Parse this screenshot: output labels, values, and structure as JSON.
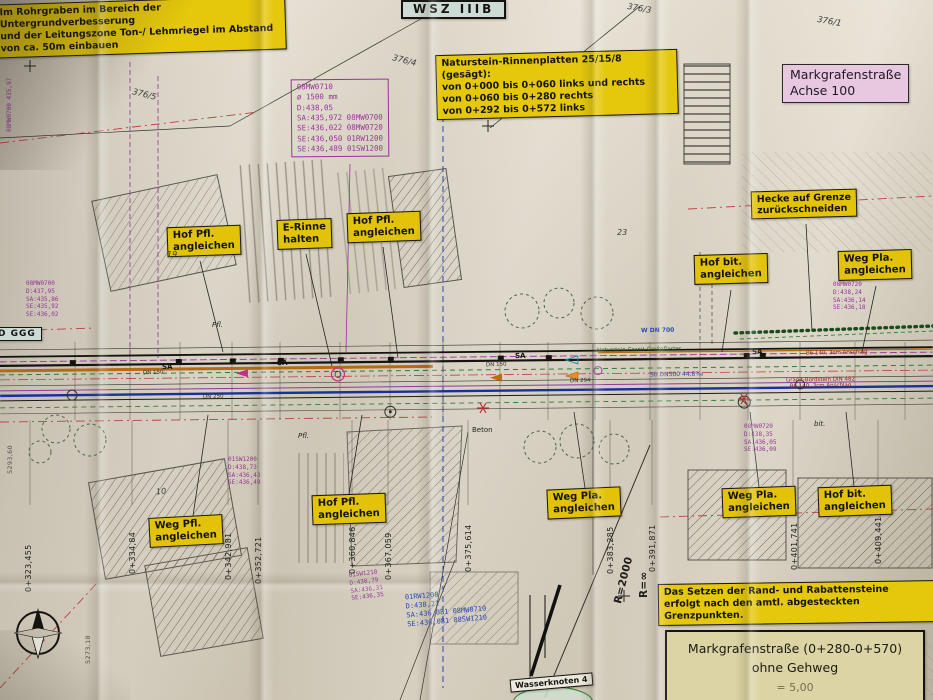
{
  "plan": {
    "zone_box": "WSZ IIIB",
    "axis_box": "Markgrafenstraße\nAchse 100",
    "left_edge_tag": "D GGG",
    "wasserknoten_tag": "Wasserknoten 4",
    "title_block": {
      "line1": "Markgrafenstraße (0+280-0+570)",
      "line2": "ohne Gehweg",
      "line3_partial": "= 5,00"
    }
  },
  "notes": {
    "pipe_trench": "Im Rohrgraben im Bereich der Untergrundverbesserung\nund der Leitungszone Ton-/ Lehmriegel im Abstand von ca. 50m einbauen",
    "gutter_slabs": "Naturstein-Rinnenplatten 25/15/8 (gesägt):\nvon 0+000 bis 0+060 links und rechts\nvon 0+060 bis 0+280 rechts\nvon 0+292 bis 0+572 links",
    "kerb_setting": "Das Setzen der Rand- und Rabattensteine\nerfolgt nach den amtl. abgesteckten Grenzpunkten."
  },
  "yellow_labels": [
    "Hof Pfl.\nangleichen",
    "E-Rinne\nhalten",
    "Hof Pfl.\nangleichen",
    "Hecke auf Grenze\nzurückschneiden",
    "Hof bit.\nangleichen",
    "Weg Pla.\nangleichen",
    "Weg Pfl.\nangleichen",
    "Hof Pfl.\nangleichen",
    "Weg Pla.\nangleichen",
    "Weg Pla.\nangleichen",
    "Hof bit.\nangleichen"
  ],
  "manhole_tables": {
    "main": "08MW0710\nø 1500 mm\nD:438,05\nSA:435,972 08MW0700\nSE:436,022 08MW0720\nSE:436,050 01RW1200\nSE:436,489 01SW1200",
    "blue": "01RW1200\nD:438,21\nSA:436,081 08MW0710\nSE:436,081 08SW1210",
    "left": "08MW0700\nD:437,95\nSA:435,86\nSE:435,92\nSE:436,02",
    "right": "08MW0720\nD:438,24\nSA:436,14\nSE:436,18",
    "center_left": "01SW1200\nD:438,73\nSA:436,43\nSE:436,49",
    "bottom_mid": "01SW1210\nD:438,79\nSA:436,31\nSE:436,35",
    "right_low": "08MW0720\nD:438,35\nSA:436,05\nSE:436,09",
    "far_left_vertical": "08MW0700 435,97"
  },
  "stations": [
    "0+323,455",
    "0+334,84",
    "0+342,981",
    "0+352,721",
    "0+360,846",
    "0+367,059",
    "0+375,614",
    "0+383,285",
    "0+391,871",
    "0+401,741",
    "0+409,441"
  ],
  "grid_coords": [
    "5293,60",
    "5273,18"
  ],
  "curve_labels": {
    "infinity": "R=∞",
    "r2000": "R=2000"
  },
  "parcel_numbers": [
    "376/5",
    "376/4",
    "376/3",
    "376/1",
    "23",
    "19",
    "10"
  ],
  "road_annotations": {
    "sa": "SA",
    "dn150": "DN 150",
    "dn250": "DN 250",
    "dn294": "DN 294",
    "w_dn700": "W DN 700",
    "sb_dn500": "Sb DN500 44,8‰",
    "pflaster": "Naturstein Granit-Großpflaster",
    "bord_short": "B6 140, 3cm Anschlag",
    "bord_long": "Granit-Bordstein DIN 482\nB6 140, 3cm Anschlag",
    "pfl": "Pfl.",
    "beton": "Beton",
    "bit": "bit."
  },
  "colors": {
    "label_yellow": "#e3c30a",
    "title_block_bg": "#dcd4a4",
    "axis_pink": "#e8c7e0",
    "zone_cyan": "#ccdbd5",
    "pipe_purple": "#993399",
    "table_blue": "#2a48b0",
    "water_blue": "#1a2f9e",
    "gas_orange": "#b56a14",
    "boundary_red": "#bb4040",
    "veg_green": "#2e7d32"
  }
}
